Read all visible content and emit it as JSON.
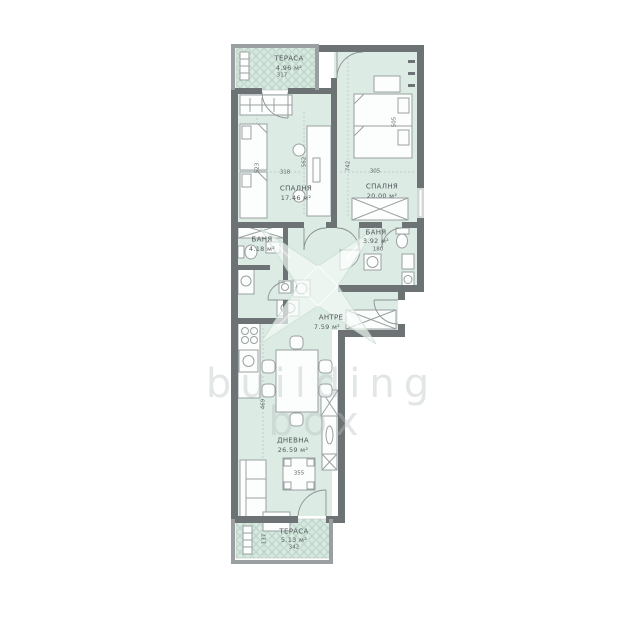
{
  "watermark": {
    "line1": "building",
    "line2": "box"
  },
  "rooms": {
    "terrace_top": {
      "name": "ТЕРАСА",
      "area": "4.96 м²",
      "number": "317"
    },
    "bedroom_left": {
      "name": "СПАЛНЯ",
      "area": "17.46 м²"
    },
    "bedroom_right": {
      "name": "СПАЛНЯ",
      "area": "20.00 м²"
    },
    "bath_left": {
      "name": "БАНЯ",
      "area": "4.18 м²"
    },
    "bath_right": {
      "name": "БАНЯ",
      "area": "3.92 м²",
      "number": "180"
    },
    "hall": {
      "name": "АНТРЕ",
      "area": "7.59 м²"
    },
    "living": {
      "name": "ДНЕВНА",
      "area": "26.59 м²"
    },
    "terrace_bottom": {
      "name": "ТЕРАСА",
      "area": "5.13 м²",
      "number": "342"
    }
  },
  "dimensions": {
    "bedroom_left_width": "318",
    "bedroom_left_height": "523",
    "bedroom_left_desk": "562",
    "bedroom_right_width": "305",
    "bedroom_right_height": "742",
    "bedroom_right_bed": "505",
    "bath_right_width": "180",
    "coffee_table": "355",
    "kitchen_height": "469",
    "terrace_bottom_height": "137"
  },
  "colors": {
    "room_fill": "#dcebe3",
    "terrace_fill": "#d6e7de",
    "terrace_hatch": "#b9d3c8",
    "wall_dark": "#6d7274",
    "wall_light": "#9aa0a2",
    "furniture_stroke": "#9aa1a1",
    "label_text": "#4f565a"
  }
}
